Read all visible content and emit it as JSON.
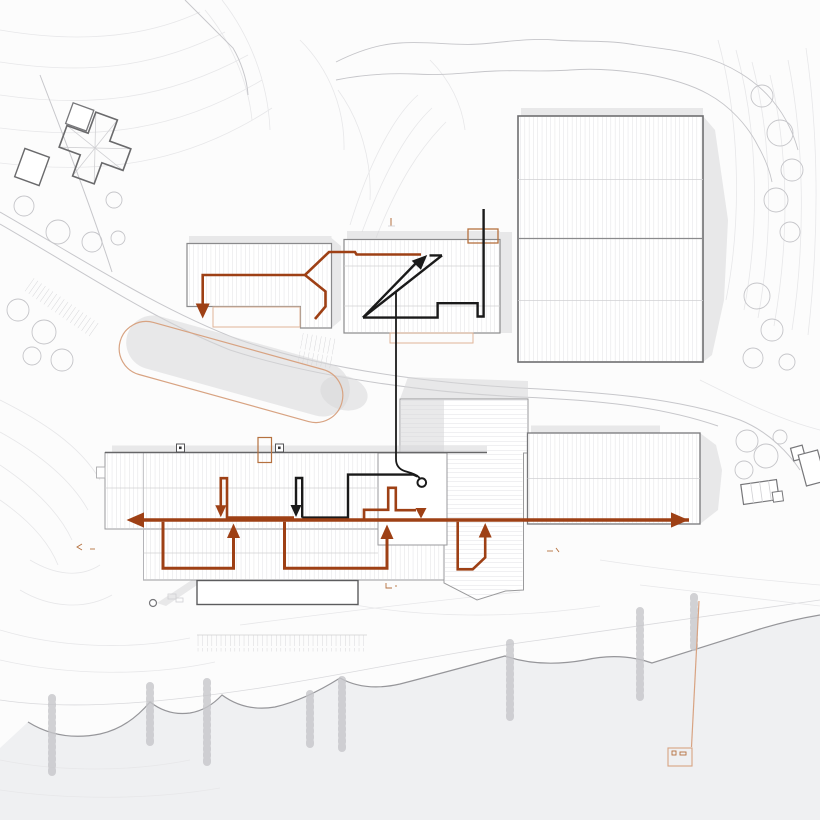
{
  "meta": {
    "title": "Architectural site plan — circulation diagram",
    "type": "site-plan",
    "description": "Monochrome site plan with hatched building roofs, topographic contours, shoreline and pier; circulation routes overlaid as rust-orange and black arrow paths. No text labels are visible in the drawing."
  },
  "colors": {
    "paper": "#fcfcfc",
    "water": "#eff0f2",
    "contour": "#e7e7e9",
    "contour2": "#d9d9dc",
    "road": "#c7c7cb",
    "tree": "#c5c5c9",
    "shore": "#96969a",
    "outline": "#979799",
    "outlinedark": "#5f5f61",
    "innerline": "#d0d0d3",
    "hatch": "#dedee1",
    "shadow": "#d7d7d9",
    "rust": "#9e4015",
    "rustlight": "#d8a382",
    "rustmid": "#b5713f",
    "ink": "#1a1a1a"
  },
  "site": {
    "buildings": [
      {
        "id": "cross-house",
        "label": "Cross-plan house, north-west corner"
      },
      {
        "id": "north-bar",
        "label": "North-west bar building with terrace"
      },
      {
        "id": "north-centre",
        "label": "North-centre building with rooftop element"
      },
      {
        "id": "north-east-hall",
        "label": "Large north-east hall, four roof bays"
      },
      {
        "id": "main-building",
        "label": "Long main building with lower wing and basement plinth"
      },
      {
        "id": "connector-block",
        "label": "Central connector block, horizontal roof decking"
      },
      {
        "id": "east-hall",
        "label": "East hall beside main axis"
      },
      {
        "id": "east-cottages",
        "label": "Small cottages at eastern edge"
      }
    ],
    "features": [
      {
        "id": "oval-landform",
        "label": "Oval landform / track outlined in light orange"
      },
      {
        "id": "forest-band",
        "label": "Vegetation band along north boundary"
      },
      {
        "id": "shoreline",
        "label": "Scalloped shoreline with tree clumps"
      },
      {
        "id": "pier",
        "label": "Pier with small bathhouse, south-east"
      },
      {
        "id": "parking",
        "label": "Parking tick rows"
      }
    ],
    "circulation": [
      {
        "id": "main-axis",
        "color": "rust",
        "label": "Primary east–west route through main building, arrowheads at both ends"
      },
      {
        "id": "north-feed",
        "color": "rust",
        "label": "Route through north buildings ending in down arrow"
      },
      {
        "id": "loop-west",
        "color": "rust",
        "label": "Lower-level loop, west, up arrow"
      },
      {
        "id": "loop-centre",
        "color": "rust",
        "label": "Lower-level loop, centre, up arrow"
      },
      {
        "id": "stair-detour",
        "color": "rust",
        "label": "Stepped detour with down arrow"
      },
      {
        "id": "east-uturn",
        "color": "rust",
        "label": "Eastern U-turn with up arrow"
      },
      {
        "id": "hairpin-west",
        "color": "rust",
        "label": "Hairpin down arrow, west"
      },
      {
        "id": "diagonal-link",
        "color": "ink",
        "label": "Black zig-zag route in north building with NE arrow, dropping south to circular node"
      },
      {
        "id": "hairpin-black",
        "color": "ink",
        "label": "Black hairpin down arrow inside main building"
      }
    ]
  }
}
